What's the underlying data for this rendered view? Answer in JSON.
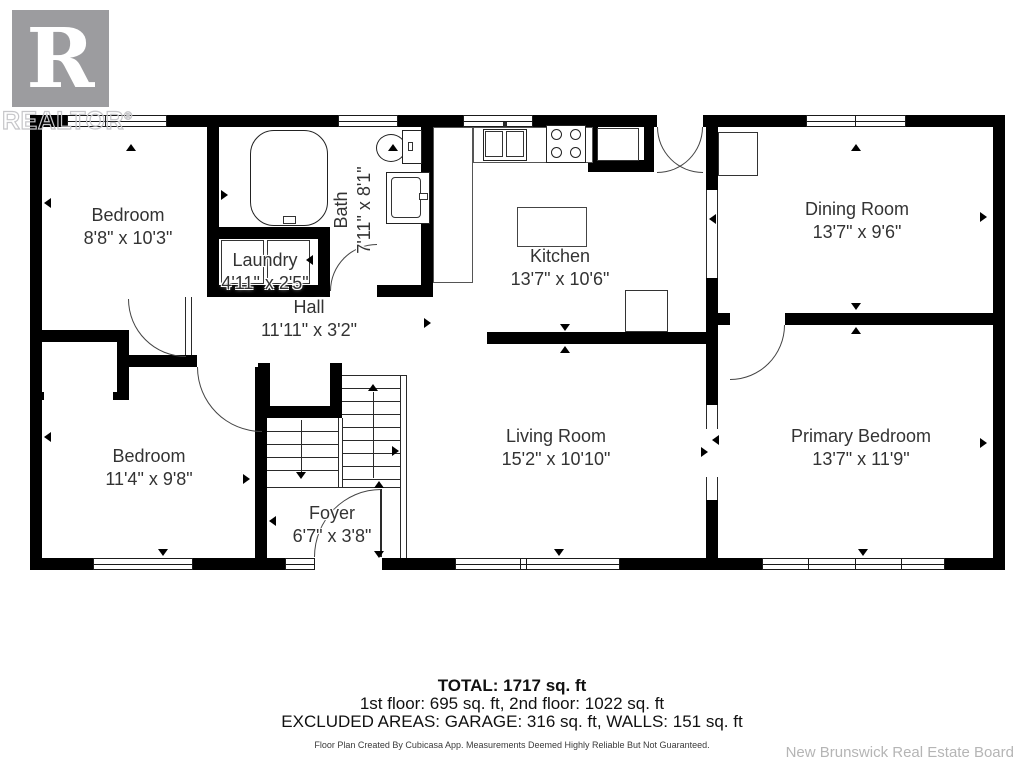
{
  "logo": {
    "letter": "R",
    "brand": "REALTOR",
    "registered": "®"
  },
  "rooms": [
    {
      "id": "bedroom1",
      "name": "Bedroom",
      "dims": "8'8\" x 10'3\""
    },
    {
      "id": "bath",
      "name": "Bath",
      "dims": "7'11\" x 8'1\""
    },
    {
      "id": "laundry",
      "name": "Laundry",
      "dims": "4'11\" x 2'5\""
    },
    {
      "id": "hall",
      "name": "Hall",
      "dims": "11'11\" x 3'2\""
    },
    {
      "id": "kitchen",
      "name": "Kitchen",
      "dims": "13'7\" x 10'6\""
    },
    {
      "id": "dining",
      "name": "Dining Room",
      "dims": "13'7\" x 9'6\""
    },
    {
      "id": "bedroom2",
      "name": "Bedroom",
      "dims": "11'4\" x 9'8\""
    },
    {
      "id": "foyer",
      "name": "Foyer",
      "dims": "6'7\" x 3'8\""
    },
    {
      "id": "living",
      "name": "Living Room",
      "dims": "15'2\" x 10'10\""
    },
    {
      "id": "primary",
      "name": "Primary Bedroom",
      "dims": "13'7\" x 11'9\""
    }
  ],
  "summary": {
    "total": "TOTAL: 1717 sq. ft",
    "floors": "1st floor: 695 sq. ft, 2nd floor: 1022 sq. ft",
    "excluded": "EXCLUDED AREAS: GARAGE: 316 sq. ft, WALLS: 151 sq. ft",
    "disclaimer": "Floor Plan Created By Cubicasa App. Measurements Deemed Highly Reliable But Not Guaranteed."
  },
  "attribution": "New Brunswick Real Estate Board",
  "colors": {
    "wall": "#000000",
    "logo_gray": "#9c9c9f",
    "logo_outline": "#c6c6c9",
    "attribution_gray": "#b5b5b5",
    "label_text": "#333333"
  }
}
